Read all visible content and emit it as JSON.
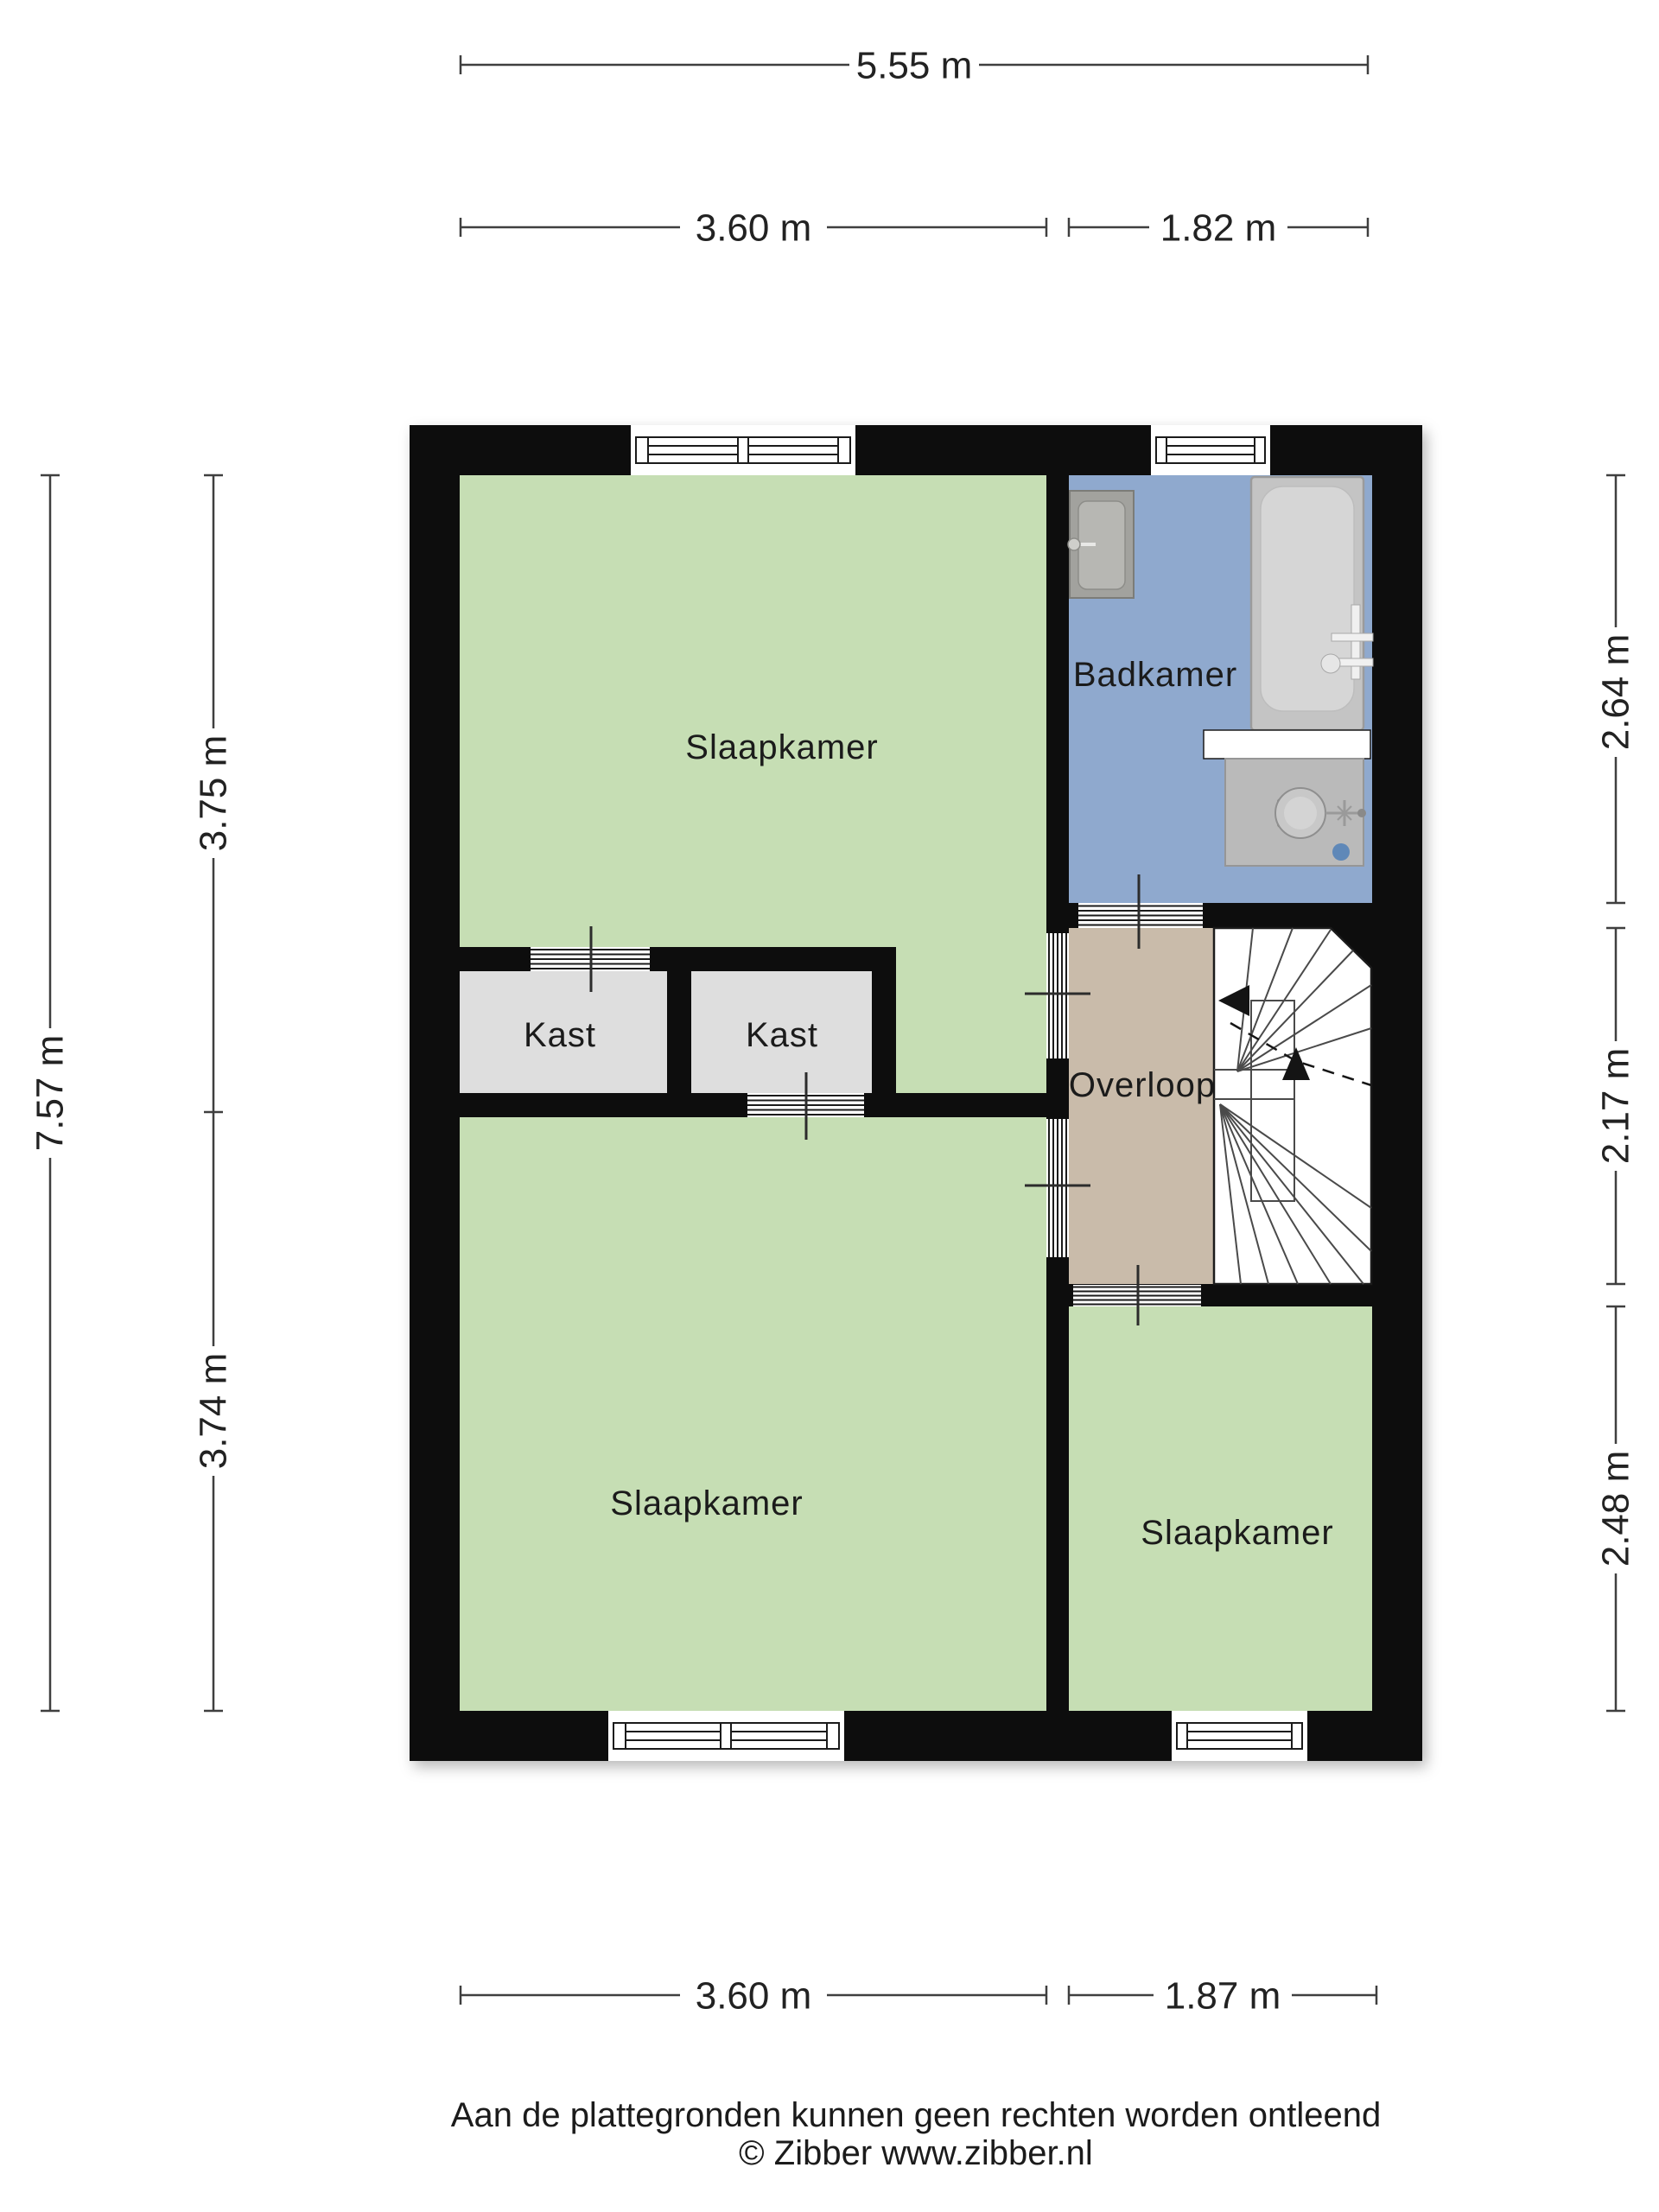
{
  "floorplan": {
    "rooms": {
      "slaapkamer_top": {
        "label": "Slaapkamer"
      },
      "slaapkamer_bottom_left": {
        "label": "Slaapkamer"
      },
      "slaapkamer_bottom_right": {
        "label": "Slaapkamer"
      },
      "badkamer": {
        "label": "Badkamer"
      },
      "overloop": {
        "label": "Overloop"
      },
      "kast_left": {
        "label": "Kast"
      },
      "kast_right": {
        "label": "Kast"
      }
    },
    "dimensions": {
      "top_total": "5.55 m",
      "top_left": "3.60 m",
      "top_right": "1.82 m",
      "bottom_left": "3.60 m",
      "bottom_right": "1.87 m",
      "left_total": "7.57 m",
      "left_upper": "3.75 m",
      "left_lower": "3.74 m",
      "right_upper": "2.64 m",
      "right_middle": "2.17 m",
      "right_lower": "2.48 m"
    },
    "colors": {
      "wall": "#0b0b0b",
      "room_green": "#c6deb4",
      "bathroom_blue": "#8fa9ce",
      "landing_tan": "#c9bbaa",
      "closet_gray": "#dedede",
      "drain_blue": "#5f88b8"
    },
    "footer": {
      "disclaimer": "Aan de plattegronden kunnen geen rechten worden ontleend",
      "copyright": "© Zibber www.zibber.nl"
    }
  }
}
